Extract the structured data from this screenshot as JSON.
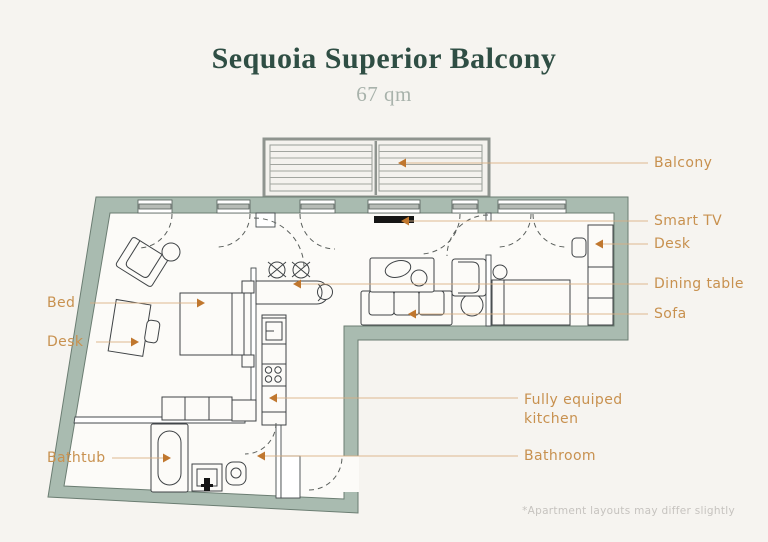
{
  "header": {
    "title": "Sequoia Superior Balcony",
    "subtitle": "67 qm"
  },
  "callouts": {
    "balcony": "Balcony",
    "smart_tv": "Smart TV",
    "desk_right": "Desk",
    "dining_table": "Dining table",
    "sofa": "Sofa",
    "kitchen": "Fully equiped\nkitchen",
    "bathroom": "Bathroom",
    "bed": "Bed",
    "desk_left": "Desk",
    "bathtub": "Bathtub"
  },
  "footnote": "*Apartment layouts may differ slightly",
  "colors": {
    "background": "#f6f4f0",
    "title": "#2f4e44",
    "subtitle": "#a8b2ab",
    "label_accent": "#c8914f",
    "arrow": "#c0772e",
    "leader_line": "#d9ae80",
    "wall": "#a9bbb0",
    "tv": "#151515"
  }
}
